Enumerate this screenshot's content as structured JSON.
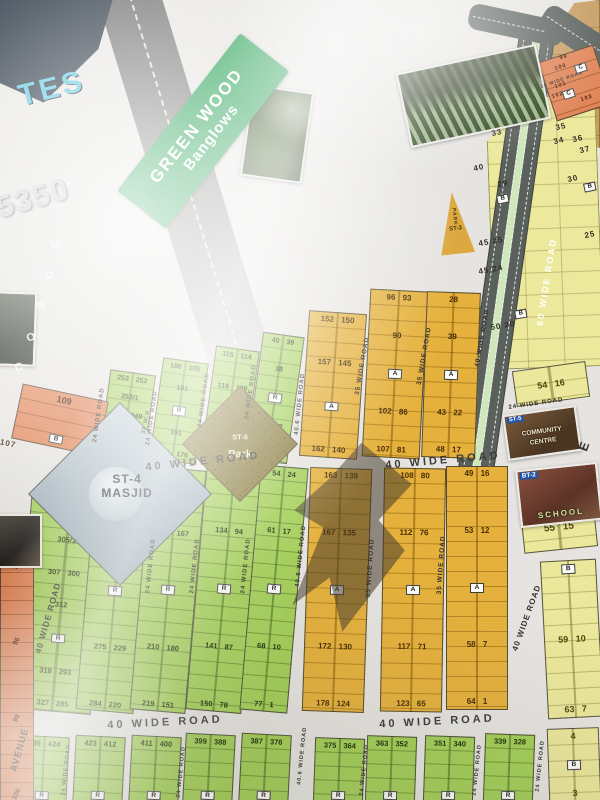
{
  "colors": {
    "paper": "#e6e4e0",
    "green_plot": "#a3cf57",
    "gold_plot": "#e5b13c",
    "yellow_plot": "#ebe79b",
    "orange_plot": "#e08355",
    "tan_area": "#c79d62",
    "road_dark": "#5a615d",
    "road_median_green": "#cfe7bb",
    "banner_green": "#1f9e4f",
    "logo_navy": "#1b2836",
    "logo_cyan": "#4fc3dd",
    "park_khaki": "#8a7c3e"
  },
  "logo": {
    "tes": "TES",
    "number": "5350"
  },
  "banner": {
    "line1": "GREEN WOOD",
    "line2": "Banglows"
  },
  "conduit": {
    "letters": [
      {
        "t": "T",
        "x": 68,
        "y": 188
      },
      {
        "t": "I",
        "x": 62,
        "y": 216
      },
      {
        "t": "U",
        "x": 56,
        "y": 246
      },
      {
        "t": "D",
        "x": 50,
        "y": 276
      },
      {
        "t": "N",
        "x": 41,
        "y": 306
      },
      {
        "t": "O",
        "x": 31,
        "y": 338
      },
      {
        "t": "C",
        "x": 19,
        "y": 368
      }
    ]
  },
  "masjid": {
    "line1": "ST-4",
    "line2": "MASJID"
  },
  "park_diamond": {
    "line1": "ST-6",
    "line2": "Park"
  },
  "park_triangle": {
    "line1": "PARK",
    "line2": "ST-3"
  },
  "community_centre": {
    "tag": "ST-5",
    "line1": "COMMUNITY",
    "line2": "CENTRE"
  },
  "school": {
    "tag": "BT-2",
    "line1": "SCHOOL"
  },
  "plot_blocks": [
    {
      "cls": "green",
      "x": 104,
      "y": 372,
      "w": 46,
      "h": 90,
      "r": 8,
      "fs": 7,
      "rows": [
        "253 252",
        "253/1",
        "256 248",
        "R",
        "260 244"
      ]
    },
    {
      "cls": "green",
      "x": 156,
      "y": 360,
      "w": 46,
      "h": 102,
      "r": 8,
      "fs": 7,
      "rows": [
        "186 105",
        "181",
        "R",
        "191",
        "185 176"
      ]
    },
    {
      "cls": "green",
      "x": 208,
      "y": 348,
      "w": 44,
      "h": 114,
      "r": 8,
      "fs": 7,
      "rows": [
        "115 114",
        "119 109",
        "R",
        "126 102"
      ]
    },
    {
      "cls": "green",
      "x": 254,
      "y": 334,
      "w": 42,
      "h": 128,
      "r": 8,
      "fs": 7,
      "rows": [
        "40 39",
        "38",
        "R",
        "46 32",
        "63 25"
      ]
    },
    {
      "cls": "green",
      "x": 22,
      "y": 500,
      "w": 78,
      "h": 212,
      "r": 5,
      "fs": 7.5,
      "rows": [
        "306",
        "305/1",
        "307 300",
        "312",
        "R",
        "318 293",
        "327 285"
      ]
    },
    {
      "cls": "green",
      "x": 86,
      "y": 470,
      "w": 58,
      "h": 242,
      "r": 5,
      "fs": 7.5,
      "rows": [
        "261 243",
        "268 236",
        "R",
        "275 229",
        "284 220"
      ]
    },
    {
      "cls": "green",
      "x": 140,
      "y": 468,
      "w": 56,
      "h": 244,
      "r": 5,
      "fs": 7.5,
      "rows": [
        "196 174",
        "203 167",
        "R",
        "210 180",
        "219 151"
      ]
    },
    {
      "cls": "green",
      "x": 196,
      "y": 466,
      "w": 56,
      "h": 246,
      "r": 5,
      "fs": 7.5,
      "rows": [
        "127 101",
        "134 94",
        "R",
        "141 87",
        "150 78"
      ]
    },
    {
      "cls": "green",
      "x": 250,
      "y": 466,
      "w": 48,
      "h": 246,
      "r": 5,
      "fs": 7.5,
      "rows": [
        "54 24",
        "61 17",
        "R",
        "68 10",
        "77 1"
      ]
    },
    {
      "cls": "green",
      "x": 18,
      "y": 736,
      "w": 50,
      "h": 68,
      "r": 3,
      "fs": 7.5,
      "rows": [
        "435 424",
        "R"
      ]
    },
    {
      "cls": "green",
      "x": 74,
      "y": 736,
      "w": 50,
      "h": 68,
      "r": 3,
      "fs": 7.5,
      "rows": [
        "423 412",
        "R"
      ]
    },
    {
      "cls": "green",
      "x": 130,
      "y": 736,
      "w": 50,
      "h": 68,
      "r": 3,
      "fs": 7.5,
      "rows": [
        "411 400",
        "R"
      ]
    },
    {
      "cls": "green",
      "x": 184,
      "y": 734,
      "w": 50,
      "h": 70,
      "r": 3,
      "fs": 7.5,
      "rows": [
        "399 388",
        "R"
      ]
    },
    {
      "cls": "green",
      "x": 240,
      "y": 734,
      "w": 50,
      "h": 70,
      "r": 3,
      "fs": 7.5,
      "rows": [
        "387 376",
        "R"
      ]
    },
    {
      "cls": "green",
      "x": 314,
      "y": 738,
      "w": 50,
      "h": 66,
      "r": 2,
      "fs": 7.5,
      "rows": [
        "375 364",
        "R"
      ]
    },
    {
      "cls": "green",
      "x": 366,
      "y": 736,
      "w": 50,
      "h": 68,
      "r": 2,
      "fs": 7.5,
      "rows": [
        "363 352",
        "R"
      ]
    },
    {
      "cls": "green",
      "x": 424,
      "y": 736,
      "w": 50,
      "h": 68,
      "r": 2,
      "fs": 7.5,
      "rows": [
        "351 340",
        "R"
      ]
    },
    {
      "cls": "green",
      "x": 484,
      "y": 734,
      "w": 50,
      "h": 70,
      "r": 2,
      "fs": 7.5,
      "rows": [
        "339 328",
        "R"
      ]
    },
    {
      "cls": "yellow",
      "x": 548,
      "y": 728,
      "w": 52,
      "h": 74,
      "r": -2,
      "fs": 9,
      "rows": [
        "4",
        "B",
        "3"
      ]
    },
    {
      "cls": "gold",
      "x": 304,
      "y": 312,
      "w": 58,
      "h": 146,
      "r": 4,
      "fs": 8,
      "rows": [
        "152 150",
        "157 145",
        "A",
        "162 140"
      ]
    },
    {
      "cls": "gold",
      "x": 366,
      "y": 290,
      "w": 58,
      "h": 168,
      "r": 3,
      "fs": 8,
      "rows": [
        "96 93",
        "90",
        "A",
        "102 86",
        "107 81"
      ]
    },
    {
      "cls": "gold",
      "x": 424,
      "y": 292,
      "w": 54,
      "h": 166,
      "r": 2,
      "fs": 8,
      "rows": [
        "28",
        "39",
        "A",
        "43 22",
        "48 17"
      ]
    },
    {
      "cls": "gold",
      "x": 306,
      "y": 468,
      "w": 62,
      "h": 244,
      "r": 2,
      "fs": 8,
      "rows": [
        "163 139",
        "167 135",
        "A",
        "172 130",
        "178 124"
      ]
    },
    {
      "cls": "gold",
      "x": 382,
      "y": 468,
      "w": 62,
      "h": 244,
      "r": 1,
      "fs": 8,
      "rows": [
        "108 80",
        "112 76",
        "A",
        "117 71",
        "123 65"
      ]
    },
    {
      "cls": "gold",
      "x": 446,
      "y": 466,
      "w": 62,
      "h": 244,
      "r": 0,
      "fs": 8,
      "rows": [
        "49 16",
        "53 12",
        "A",
        "58 7",
        "64 1"
      ]
    },
    {
      "cls": "yellow",
      "x": 514,
      "y": 366,
      "w": 74,
      "h": 36,
      "r": -8,
      "fs": 9,
      "rows": [
        "54 16"
      ]
    },
    {
      "cls": "yellow",
      "x": 522,
      "y": 506,
      "w": 74,
      "h": 44,
      "r": -6,
      "fs": 10,
      "rows": [
        "55 15"
      ]
    },
    {
      "cls": "yellow",
      "x": 544,
      "y": 560,
      "w": 56,
      "h": 158,
      "r": -3,
      "fs": 9,
      "rows": [
        "B",
        "59 10",
        "63 7"
      ]
    },
    {
      "cls": "orange",
      "x": 546,
      "y": 52,
      "w": 58,
      "h": 62,
      "r": -18,
      "fs": 6,
      "rows": []
    },
    {
      "cls": "orange",
      "x": 16,
      "y": 392,
      "w": 88,
      "h": 56,
      "r": 12,
      "fs": 9,
      "rows": [
        "109",
        "B"
      ]
    },
    {
      "cls": "orange vert",
      "x": 0,
      "y": 558,
      "w": 34,
      "h": 244,
      "r": 0,
      "fs": 7,
      "rows": [
        "90",
        "96",
        "98",
        "106"
      ]
    }
  ],
  "road_labels": [
    {
      "t": "24 WIDE ROAD",
      "x": 99,
      "y": 415,
      "r": -82,
      "s": 6
    },
    {
      "t": "24 WIDE ROAD",
      "x": 152,
      "y": 418,
      "r": -82,
      "s": 6
    },
    {
      "t": "24 WIDE ROAD",
      "x": 204,
      "y": 400,
      "r": -82,
      "s": 6
    },
    {
      "t": "24 WIDE ROAD",
      "x": 251,
      "y": 392,
      "r": -82,
      "s": 6
    },
    {
      "t": "40.6 WIDE ROAD",
      "x": 300,
      "y": 404,
      "r": -84,
      "s": 6
    },
    {
      "t": "35 WIDE ROAD",
      "x": 363,
      "y": 366,
      "r": -80,
      "s": 6.5
    },
    {
      "t": "35 WIDE ROAD",
      "x": 425,
      "y": 356,
      "r": -80,
      "s": 6.5
    },
    {
      "t": "40 WIDE ROAD",
      "x": 483,
      "y": 338,
      "r": -80,
      "s": 6.5
    },
    {
      "t": "80 WIDE ROAD",
      "x": 547,
      "y": 282,
      "r": -81,
      "s": 9,
      "c": "#ffffff",
      "ls": 2
    },
    {
      "t": "24 WIDE ROAD",
      "x": 536,
      "y": 404,
      "r": -8,
      "s": 6
    },
    {
      "t": "40 WIDE ROAD",
      "x": 203,
      "y": 462,
      "r": -6,
      "s": 11,
      "c": "#3b3b38",
      "ls": 3
    },
    {
      "t": "40 WIDE ROAD",
      "x": 443,
      "y": 461,
      "r": -5,
      "s": 11,
      "c": "#3b3b38",
      "ls": 3
    },
    {
      "t": "24 WIDE ROAD",
      "x": 151,
      "y": 566,
      "r": -84,
      "s": 6
    },
    {
      "t": "24 WIDE ROAD",
      "x": 195,
      "y": 566,
      "r": -84,
      "s": 6
    },
    {
      "t": "24 WIDE ROAD",
      "x": 246,
      "y": 566,
      "r": -84,
      "s": 6
    },
    {
      "t": "40.6 WIDE ROAD",
      "x": 301,
      "y": 556,
      "r": -84,
      "s": 6
    },
    {
      "t": "35 WIDE ROAD",
      "x": 371,
      "y": 568,
      "r": -86,
      "s": 6.5
    },
    {
      "t": "35 WIDE ROAD",
      "x": 442,
      "y": 565,
      "r": -86,
      "s": 6.5
    },
    {
      "t": "40 WIDE ROAD",
      "x": 527,
      "y": 618,
      "r": -70,
      "s": 8
    },
    {
      "t": "30 W R",
      "x": 147,
      "y": 422,
      "r": -78,
      "s": 5.5
    },
    {
      "t": "40 WIDE ROAD",
      "x": 48,
      "y": 618,
      "r": -74,
      "s": 8.5
    },
    {
      "t": "AVENUE",
      "x": 20,
      "y": 750,
      "r": -74,
      "s": 9.5
    },
    {
      "t": "40 WIDE ROAD",
      "x": 165,
      "y": 723,
      "r": -3,
      "s": 11,
      "c": "#3b3b38",
      "ls": 3
    },
    {
      "t": "40 WIDE ROAD",
      "x": 437,
      "y": 722,
      "r": -3,
      "s": 11,
      "c": "#3b3b38",
      "ls": 3
    },
    {
      "t": "24 WIDE ROAD",
      "x": 67,
      "y": 770,
      "r": -84,
      "s": 5.5
    },
    {
      "t": "24 WIDE ROAD",
      "x": 182,
      "y": 772,
      "r": -84,
      "s": 5.5
    },
    {
      "t": "24 WIDE ROAD",
      "x": 365,
      "y": 770,
      "r": -84,
      "s": 5.5
    },
    {
      "t": "24 WIDE ROAD",
      "x": 478,
      "y": 770,
      "r": -84,
      "s": 5.5
    },
    {
      "t": "24 WIDE ROAD",
      "x": 541,
      "y": 766,
      "r": -84,
      "s": 5.5
    },
    {
      "t": "40.6 WIDE ROAD",
      "x": 303,
      "y": 756,
      "r": -84,
      "s": 5.5
    },
    {
      "t": "24 WIDE ROAD",
      "x": 562,
      "y": 80,
      "r": -19,
      "s": 4.5
    },
    {
      "t": "E",
      "x": 584,
      "y": 446,
      "r": -70,
      "s": 13,
      "c": "#33302a"
    }
  ],
  "floating_labels": [
    {
      "t": "33",
      "x": 497,
      "y": 133,
      "r": -12,
      "s": 8
    },
    {
      "t": "40",
      "x": 479,
      "y": 168,
      "r": -12,
      "s": 8
    },
    {
      "t": "29",
      "x": 503,
      "y": 184,
      "r": -12,
      "s": 8
    },
    {
      "t": "45 25",
      "x": 491,
      "y": 242,
      "r": -10,
      "s": 8
    },
    {
      "t": "45 24",
      "x": 491,
      "y": 270,
      "r": -10,
      "s": 8
    },
    {
      "t": "50 20",
      "x": 503,
      "y": 326,
      "r": -10,
      "s": 8
    },
    {
      "t": "35",
      "x": 561,
      "y": 127,
      "r": -14,
      "s": 8
    },
    {
      "t": "34",
      "x": 559,
      "y": 141,
      "r": -14,
      "s": 8
    },
    {
      "t": "36",
      "x": 578,
      "y": 139,
      "r": -14,
      "s": 8
    },
    {
      "t": "37",
      "x": 585,
      "y": 150,
      "r": -14,
      "s": 8
    },
    {
      "t": "30",
      "x": 573,
      "y": 179,
      "r": -12,
      "s": 8
    },
    {
      "t": "25",
      "x": 590,
      "y": 235,
      "r": -12,
      "s": 8
    },
    {
      "t": "99",
      "x": 564,
      "y": 58,
      "r": -18,
      "s": 5.5,
      "c": "#3a1505"
    },
    {
      "t": "100",
      "x": 561,
      "y": 68,
      "r": -18,
      "s": 5.5,
      "c": "#3a1505"
    },
    {
      "t": "101",
      "x": 561,
      "y": 86,
      "r": -18,
      "s": 5.5,
      "c": "#3a1505"
    },
    {
      "t": "102",
      "x": 558,
      "y": 96,
      "r": -18,
      "s": 5.5,
      "c": "#3a1505"
    },
    {
      "t": "103",
      "x": 587,
      "y": 99,
      "r": -18,
      "s": 5.5,
      "c": "#3a1505"
    },
    {
      "t": "107",
      "x": 8,
      "y": 444,
      "r": 12,
      "s": 8,
      "c": "#3a1505"
    }
  ],
  "floating_badges": [
    {
      "t": "B",
      "x": 503,
      "y": 199,
      "r": -12
    },
    {
      "t": "B",
      "x": 521,
      "y": 314,
      "r": -10
    },
    {
      "t": "B",
      "x": 590,
      "y": 187,
      "r": -12
    },
    {
      "t": "C",
      "x": 581,
      "y": 68,
      "r": -18
    },
    {
      "t": "C",
      "x": 569,
      "y": 94,
      "r": -18
    }
  ]
}
